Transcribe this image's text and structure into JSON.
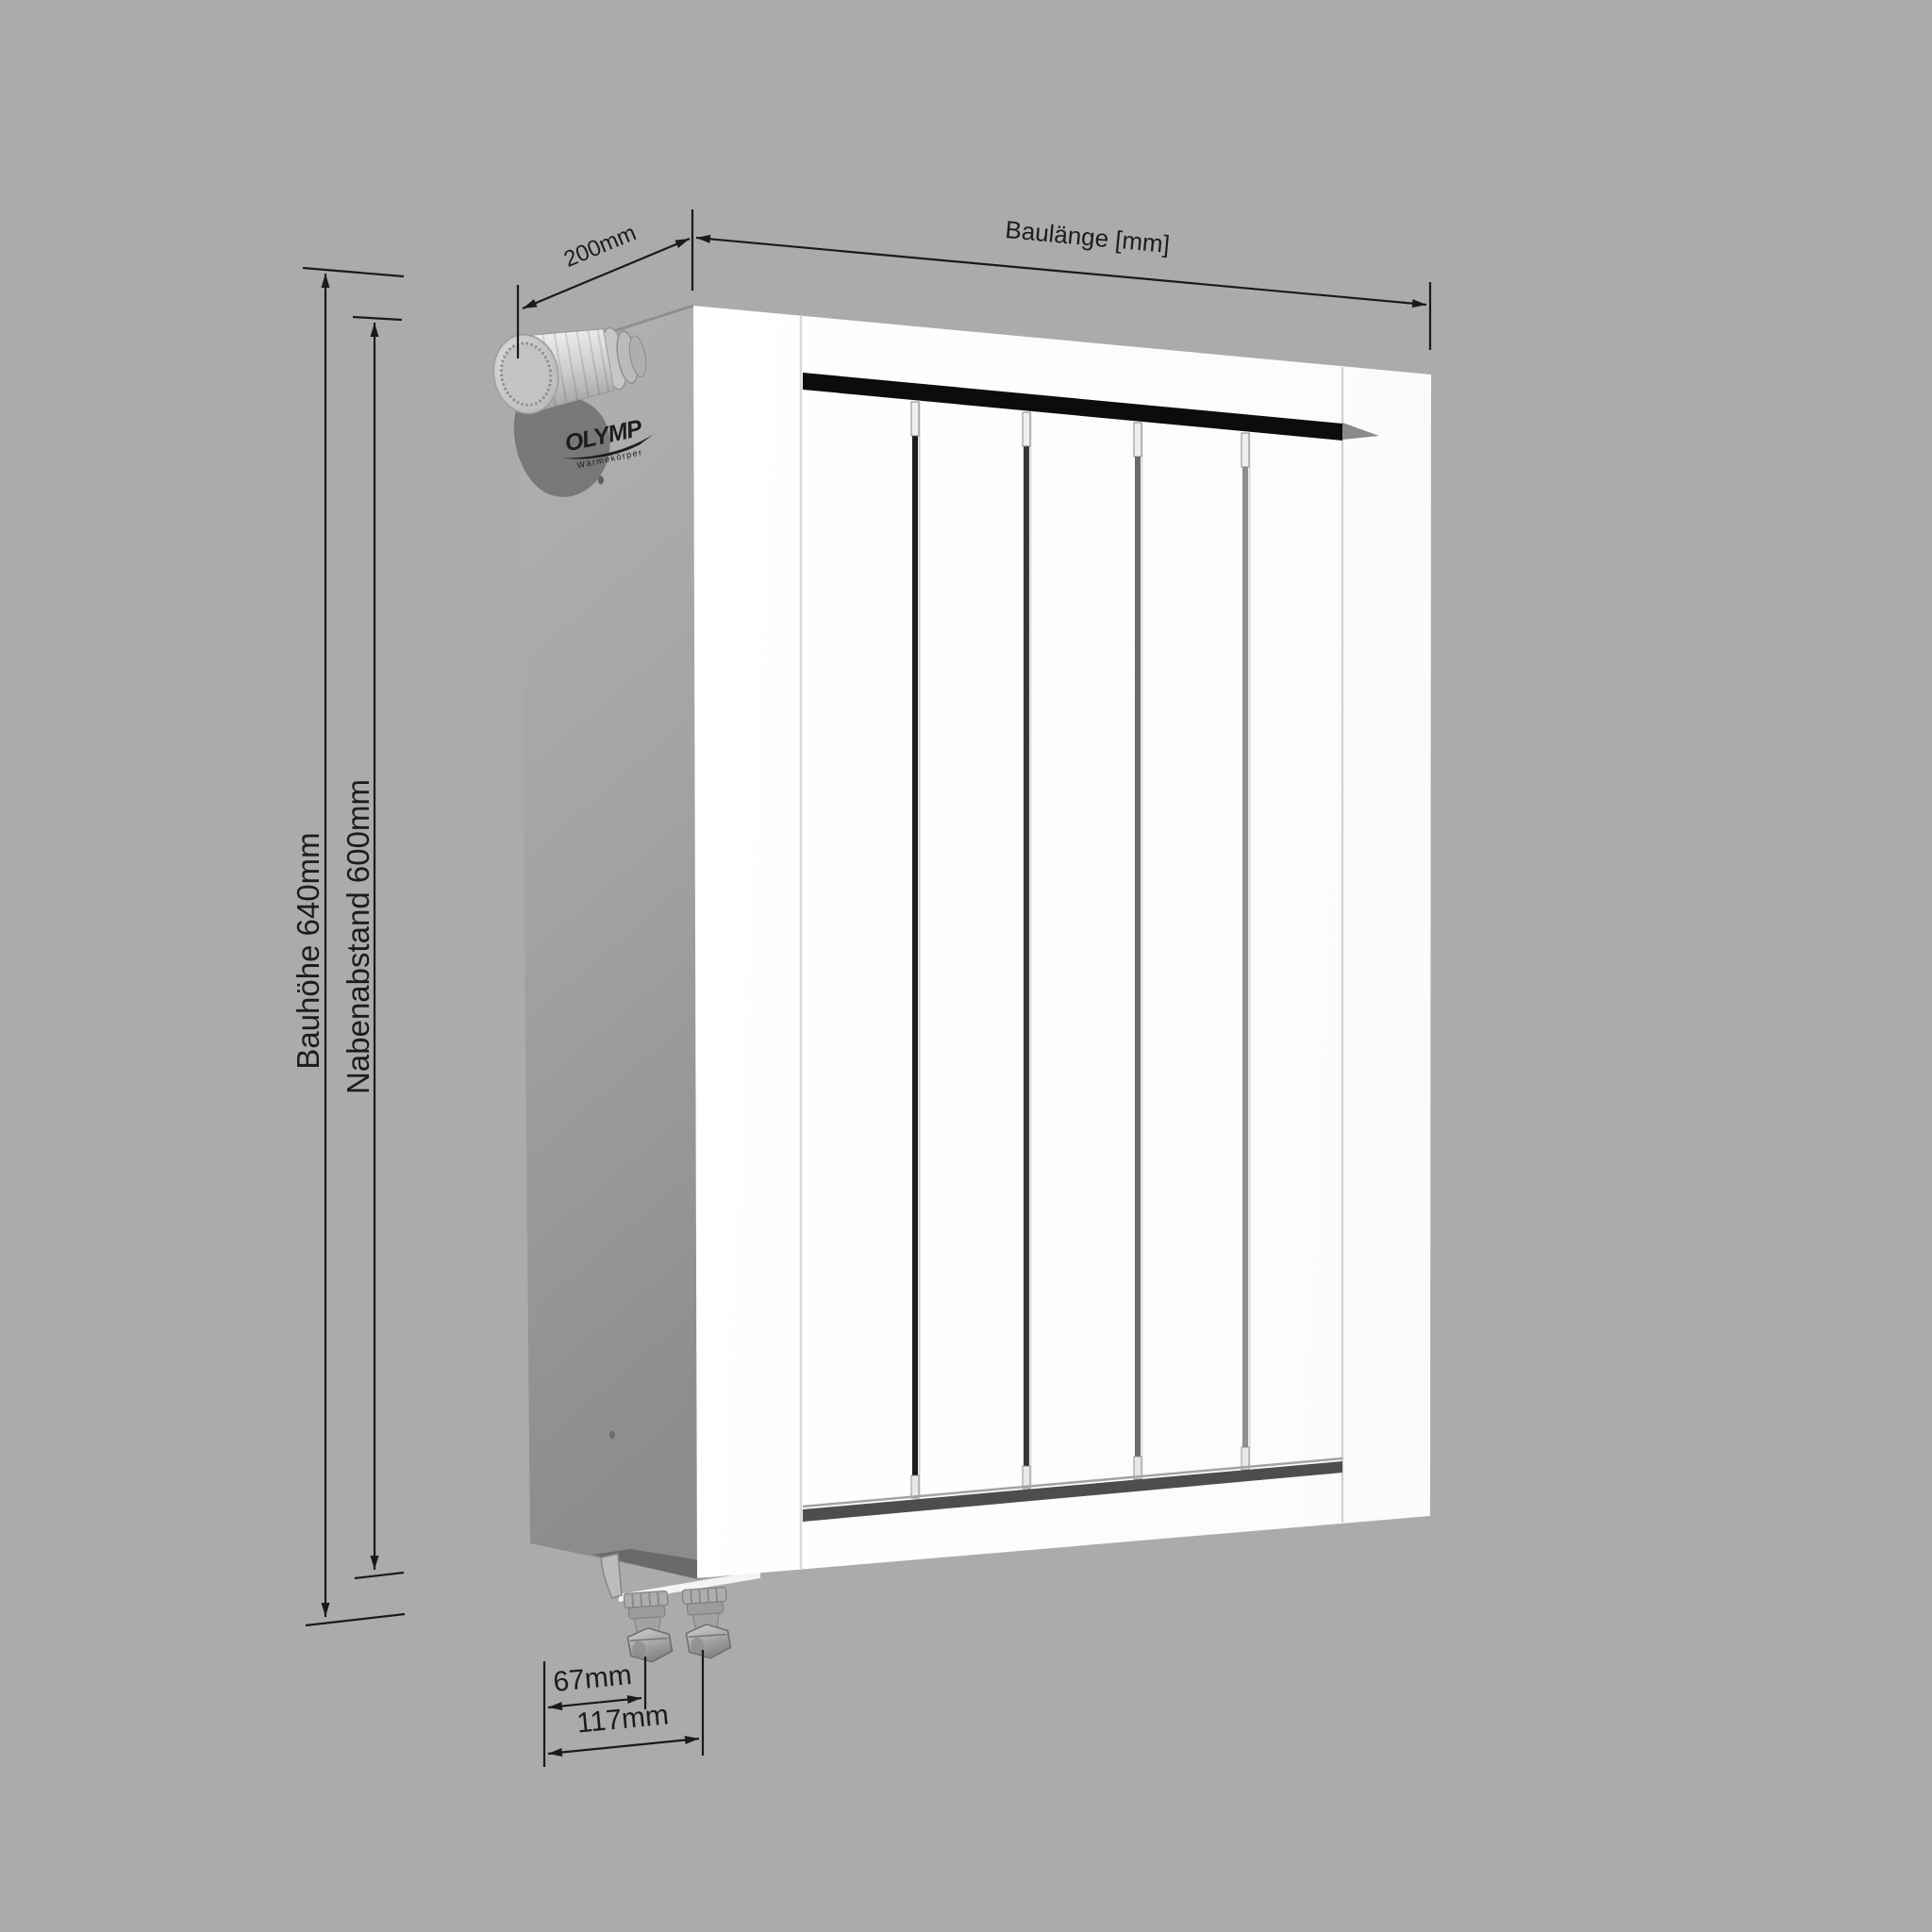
{
  "meta": {
    "background_color": "#ababab",
    "line_color": "#1a1a1a",
    "radiator_front_color": "#ffffff",
    "top_gap_color": "#0c0c0c"
  },
  "brand": {
    "name": "OLYMP",
    "tagline": "Wärmekörper"
  },
  "radiator": {
    "visible_fins": 5,
    "fin_gaps": 4,
    "valves_visible": 2
  },
  "dimensions": {
    "depth": {
      "label": "200mm"
    },
    "length": {
      "label": "Baulänge [mm]"
    },
    "height": {
      "label": "Bauhöhe 640mm"
    },
    "hub_distance": {
      "label": "Nabenabstand 600mm"
    },
    "valve_offset_inner": {
      "label": "67mm"
    },
    "valve_offset_outer": {
      "label": "117mm"
    }
  }
}
